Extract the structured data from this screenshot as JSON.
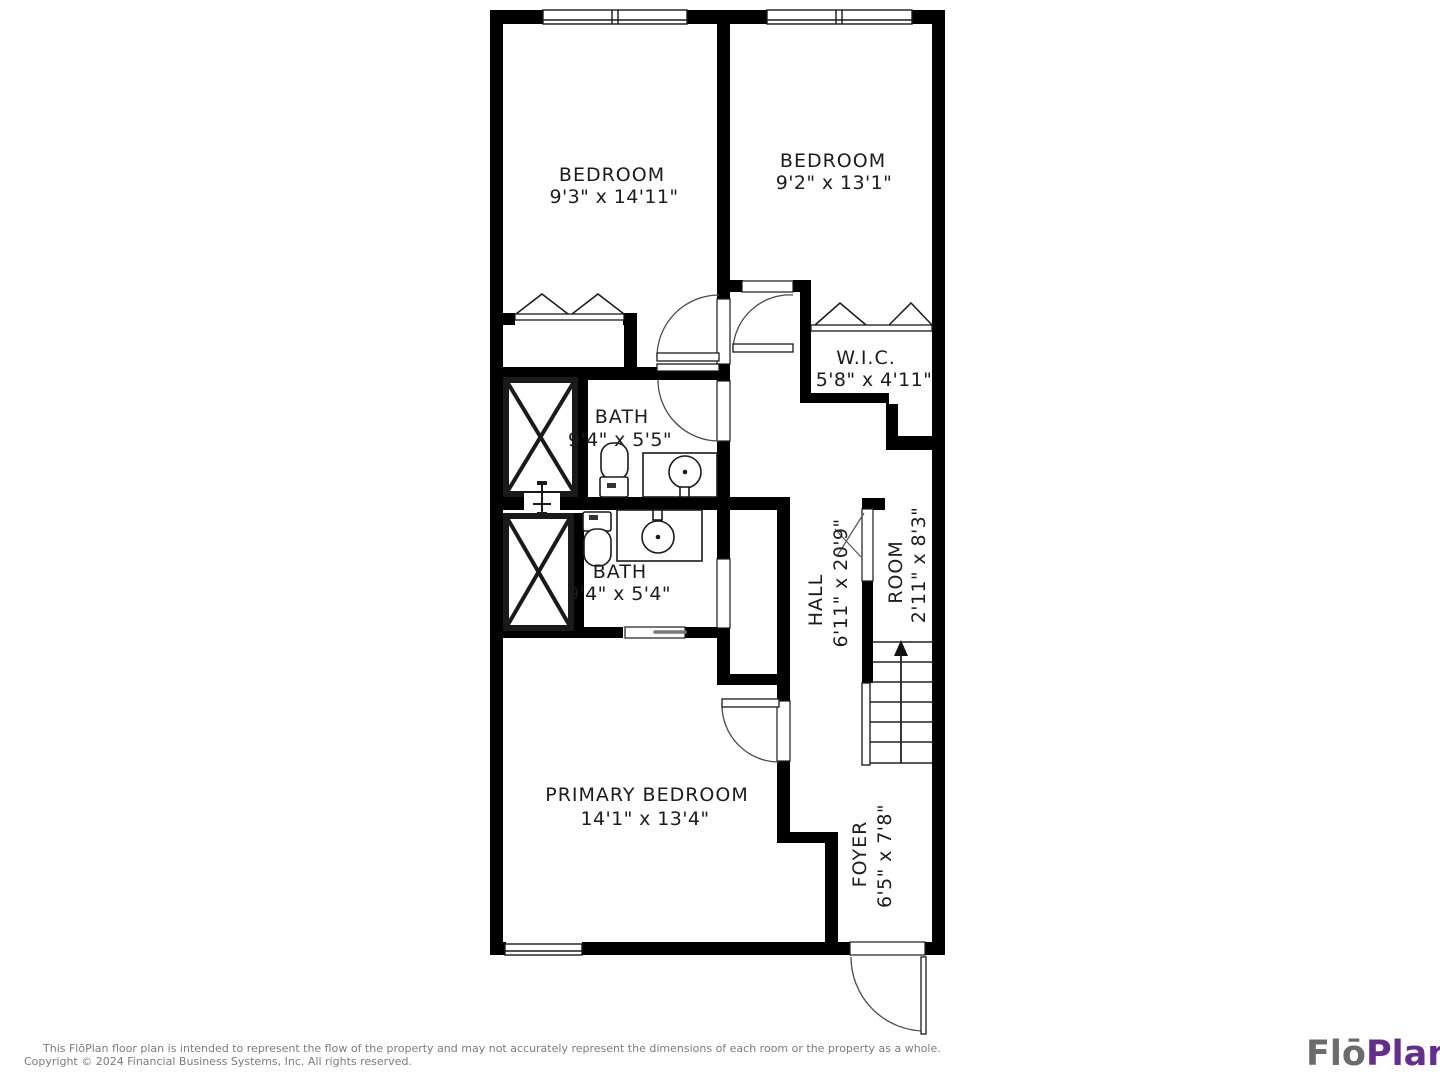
{
  "plan_title": "FloPlan floor plan - upper level residential unit",
  "colors": {
    "wall": "#000000",
    "label_text": "#1c1c1c",
    "footer_text": "#7b7b7b",
    "logo_gray": "#6b6b6e",
    "logo_purple": "#662d91"
  },
  "rooms": {
    "bedroom1": {
      "name": "BEDROOM",
      "dims": "9'3\" x 14'11\""
    },
    "bedroom2": {
      "name": "BEDROOM",
      "dims": "9'2\" x 13'1\""
    },
    "wic": {
      "name": "W.I.C.",
      "dims": "5'8\" x 4'11\""
    },
    "bath1": {
      "name": "BATH",
      "dims": "9'4\" x 5'5\""
    },
    "bath2": {
      "name": "BATH",
      "dims": "9'4\" x 5'4\""
    },
    "hall": {
      "name": "HALL",
      "dims": "6'11\" x 20'9\""
    },
    "room": {
      "name": "ROOM",
      "dims": "2'11\" x 8'3\""
    },
    "primary": {
      "name": "PRIMARY BEDROOM",
      "dims": "14'1\" x 13'4\""
    },
    "foyer": {
      "name": "FOYER",
      "dims": "6'5\" x 7'8\""
    }
  },
  "footer": {
    "line1": "This FlōPlan floor plan is intended to represent the flow of the property and may not accurately represent the dimensions of each room or the property as a whole.",
    "line2": "Copyright © 2024 Financial Business Systems, Inc. All rights reserved."
  },
  "logo": {
    "part1": "Flō",
    "part2": "Plan"
  }
}
